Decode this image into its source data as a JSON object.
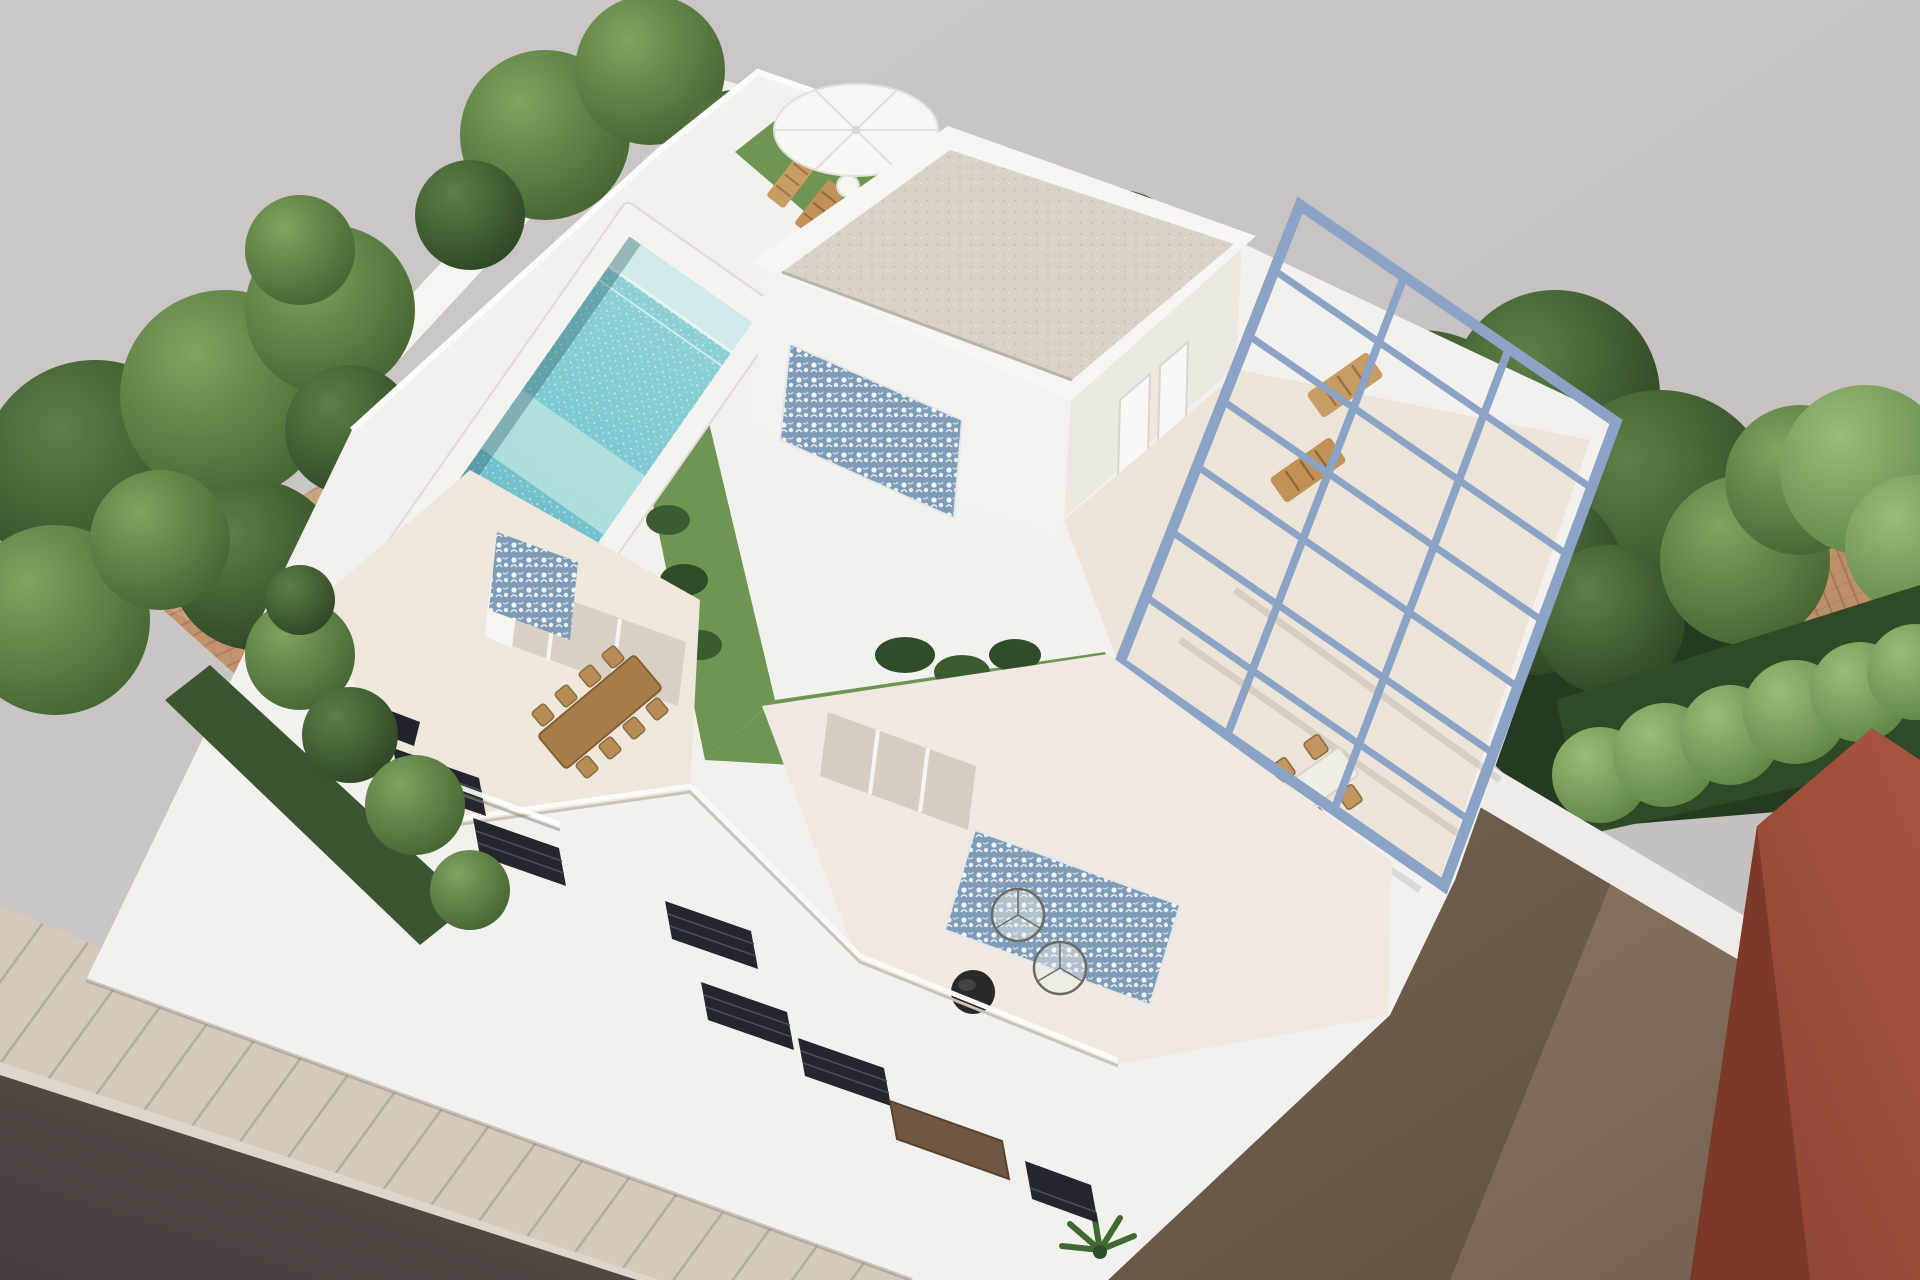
{
  "scene": {
    "type": "3d-architectural-render",
    "description": "Aerial 3D rendering of a modern white two-storey villa with rooftop pool, artificial-grass roof garden, blue steel pergola over a roof terrace, balconies with outdoor furniture, neighbouring terracotta-roof houses, trees, a dirt side lot and a street with sidewalk",
    "palette": {
      "background_gray": "#c9c4c4",
      "street_asphalt": "#544b46",
      "sidewalk": "#d3cabc",
      "building_white": "#f3f1ee",
      "parapet_white": "#fbfaf8",
      "terrace_floor_cream": "#ece4d7",
      "gravel_roof": "#d8d2c8",
      "pool_coping": "#f5f3f0",
      "pool_water_deep": "#62b5c2",
      "pool_water_light": "#a7dcdd",
      "grass_green": "#6f9553",
      "tree_dark_green": "#3c5a33",
      "hedge_green": "#5d8a44",
      "terracotta_roof": "#c0916c",
      "pergola_steel_blue": "#8ba3c6",
      "mosaic_tile_blue": "#7e9cb7",
      "wood_furniture": "#bb8f5c",
      "glass_door": "#d5cdc1",
      "dirt_lot": "#8b7964",
      "red_building": "#9e4e38",
      "dark_window": "#23272d",
      "brown_door": "#6f5742"
    },
    "objects": [
      "rooftop-pool",
      "pool-steps",
      "sun-umbrella",
      "sun-loungers",
      "roof-grass-garden",
      "penthouse-roof-structure",
      "mosaic-feature-wall",
      "penthouse-doors",
      "steel-pergola",
      "pergola-lounge-chairs",
      "pergola-dining-set",
      "upper-terrace-dining-table",
      "wire-lounge-chairs",
      "round-black-table",
      "sliding-glass-doors",
      "balcony-windows",
      "palm-plant",
      "tropical-plants",
      "left-neighbor-terracotta-roof",
      "right-neighbor-terracotta-roof",
      "boundary-walls",
      "trees",
      "hedge-row",
      "dirt-lot",
      "red-neighbor-building",
      "street",
      "sidewalk"
    ]
  }
}
